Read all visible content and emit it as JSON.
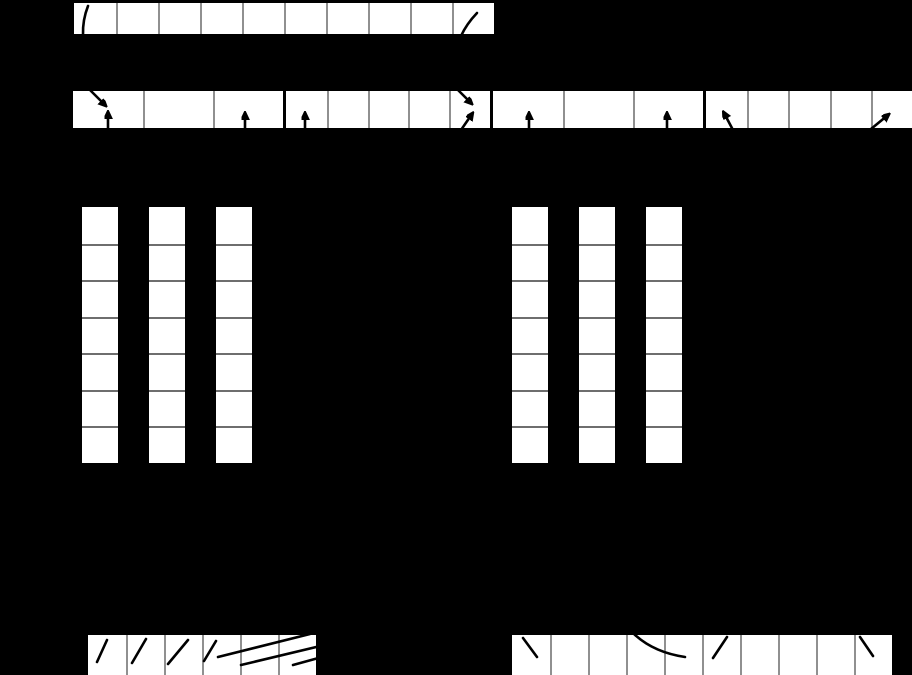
{
  "canvas": {
    "width": 912,
    "height": 675,
    "background": "#000000"
  },
  "styles": {
    "cell_fill": "#ffffff",
    "row_separator": "#909090",
    "column_separator": "#6e6e6e",
    "stroke_color": "#000000"
  },
  "arrays": [
    {
      "name": "top-run-array",
      "direction": "row",
      "x": 74,
      "y": 3,
      "cells": 10,
      "cellWidth": 42,
      "cellHeight": 31
    },
    {
      "name": "buffer-group-1",
      "direction": "row",
      "x": 73,
      "y": 91,
      "cells": 3,
      "cellWidth": 70,
      "cellHeight": 37
    },
    {
      "name": "buffer-group-2",
      "direction": "row",
      "x": 286,
      "y": 91,
      "cells": 5,
      "cellWidth": 40.8,
      "cellHeight": 37
    },
    {
      "name": "buffer-group-3",
      "direction": "row",
      "x": 493,
      "y": 91,
      "cells": 3,
      "cellWidth": 70,
      "cellHeight": 37
    },
    {
      "name": "buffer-group-4",
      "direction": "row",
      "x": 706,
      "y": 91,
      "cells": 5,
      "cellWidth": 41.2,
      "cellHeight": 37
    },
    {
      "name": "page-column-left-1",
      "direction": "column",
      "x": 82,
      "y": 207,
      "cells": 7,
      "cellWidth": 36,
      "cellHeight": 36.5
    },
    {
      "name": "page-column-left-2",
      "direction": "column",
      "x": 149,
      "y": 207,
      "cells": 7,
      "cellWidth": 36,
      "cellHeight": 36.5
    },
    {
      "name": "page-column-left-3",
      "direction": "column",
      "x": 216,
      "y": 207,
      "cells": 7,
      "cellWidth": 36,
      "cellHeight": 36.5
    },
    {
      "name": "page-column-right-1",
      "direction": "column",
      "x": 512,
      "y": 207,
      "cells": 7,
      "cellWidth": 36,
      "cellHeight": 36.5
    },
    {
      "name": "page-column-right-2",
      "direction": "column",
      "x": 579,
      "y": 207,
      "cells": 7,
      "cellWidth": 36,
      "cellHeight": 36.5
    },
    {
      "name": "page-column-right-3",
      "direction": "column",
      "x": 646,
      "y": 207,
      "cells": 7,
      "cellWidth": 36,
      "cellHeight": 36.5
    },
    {
      "name": "bottom-run-left",
      "direction": "row",
      "x": 88,
      "y": 635,
      "cells": 6,
      "cellWidth": 38,
      "cellHeight": 40
    },
    {
      "name": "bottom-run-right",
      "direction": "row",
      "x": 512,
      "y": 635,
      "cells": 10,
      "cellWidth": 38,
      "cellHeight": 40
    }
  ],
  "marks": {
    "arrows": [
      {
        "name": "diagonal-pointer-arrow-buffer1-cell1",
        "x1": 77,
        "y1": 77,
        "x2": 105,
        "y2": 105
      },
      {
        "name": "up-pointer-arrow-buffer1-cell1",
        "x1": 108,
        "y1": 132,
        "x2": 108,
        "y2": 113
      },
      {
        "name": "up-pointer-arrow-buffer1-cell3",
        "x1": 245,
        "y1": 132,
        "x2": 245,
        "y2": 114
      },
      {
        "name": "up-pointer-arrow-buffer2-cell1",
        "x1": 305,
        "y1": 132,
        "x2": 305,
        "y2": 114
      },
      {
        "name": "diagonal-pointer-arrow-buffer2-cell5",
        "x1": 451,
        "y1": 83,
        "x2": 471,
        "y2": 103
      },
      {
        "name": "upright-pointer-arrow-buffer2-cell5",
        "x1": 461,
        "y1": 130,
        "x2": 472,
        "y2": 114
      },
      {
        "name": "up-pointer-arrow-buffer3-cell1",
        "x1": 529,
        "y1": 132,
        "x2": 529,
        "y2": 114
      },
      {
        "name": "up-pointer-arrow-buffer3-cell3",
        "x1": 667,
        "y1": 132,
        "x2": 667,
        "y2": 114
      },
      {
        "name": "upleft-pointer-arrow-buffer4-cell1",
        "x1": 733,
        "y1": 130,
        "x2": 724,
        "y2": 113
      },
      {
        "name": "upright-pointer-arrow-buffer4-cell5",
        "x1": 871,
        "y1": 129,
        "x2": 888,
        "y2": 115
      }
    ],
    "strokes": [
      {
        "name": "curved-stroke-toprun-cell1",
        "path": "M 88 6 Q 82.5 20 83 35"
      },
      {
        "name": "curved-stroke-toprun-cell10",
        "path": "M 477 13 Q 466.5 24 461 36"
      },
      {
        "name": "slash-bottomleft-cell1",
        "path": "M 97 662 L 107 640"
      },
      {
        "name": "slash-bottomleft-cell2",
        "path": "M 132 663 L 146 639"
      },
      {
        "name": "slash-bottomleft-cell3",
        "path": "M 168 664 L 188 640"
      },
      {
        "name": "slash-bottomleft-cell4",
        "path": "M 204 661 L 216 641"
      },
      {
        "name": "long-line-bottomleft-1",
        "path": "M 218 657 L 310 634"
      },
      {
        "name": "long-line-bottomleft-2",
        "path": "M 241 665 L 333 643"
      },
      {
        "name": "long-line-bottomleft-3",
        "path": "M 293 665 L 333 654"
      },
      {
        "name": "backslash-bottomright-cell1",
        "path": "M 523 638 L 537 657"
      },
      {
        "name": "curve-bottomright-cells4-5",
        "path": "M 631 631 Q 651 652 685 657"
      },
      {
        "name": "slash-bottomright-cell6",
        "path": "M 713 658 L 727 637"
      },
      {
        "name": "backslash-bottomright-cell10",
        "path": "M 860 637 L 873 656"
      }
    ]
  }
}
